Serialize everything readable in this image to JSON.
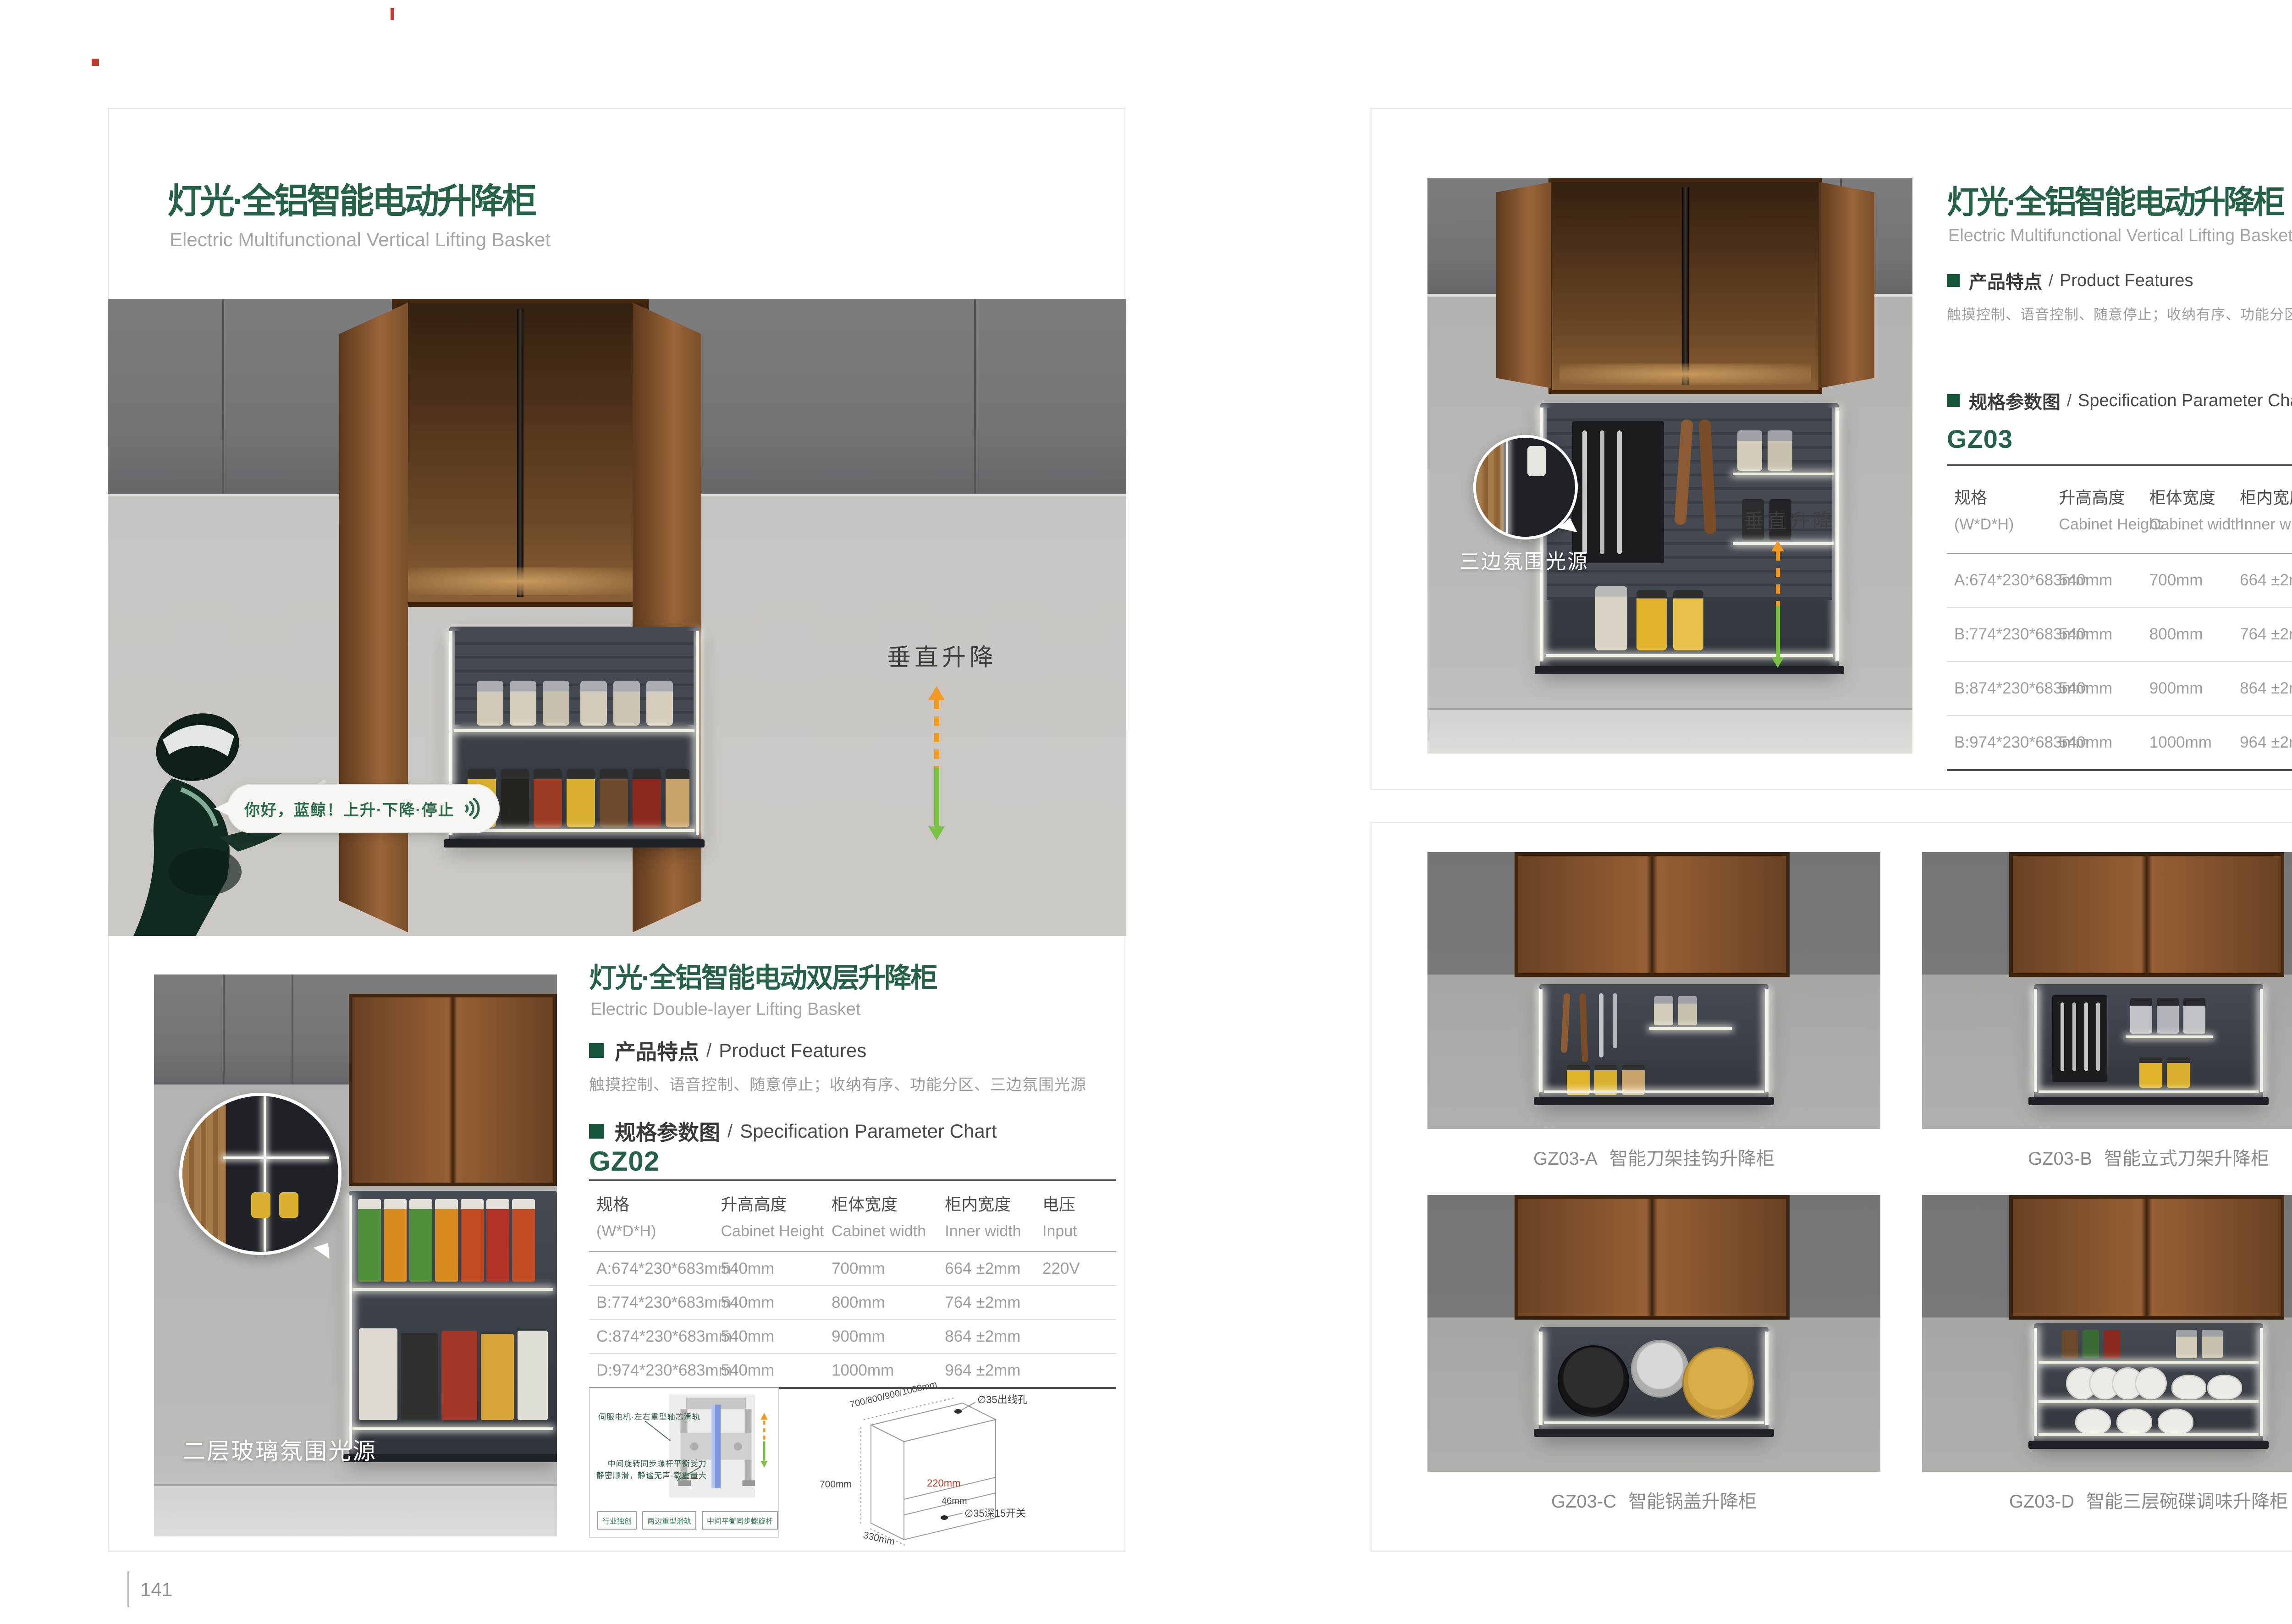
{
  "shared": {
    "sep": "/"
  },
  "colors": {
    "brand_green": "#266247",
    "arrow_orange": "#F29A22",
    "arrow_green": "#7BC143",
    "dim_red": "#C0392B"
  },
  "left_page": {
    "page_number": "141",
    "title": "灯光·全铝智能电动升降柜",
    "subtitle": "Electric Multifunctional Vertical Lifting Basket",
    "hero": {
      "speech_text": "你好，蓝鲸！上升·下降·停止",
      "motion_label": "垂直升降"
    },
    "double_layer": {
      "title": "灯光·全铝智能电动双层升降柜",
      "subtitle": "Electric Double-layer Lifting Basket",
      "features_heading_zh": "产品特点",
      "features_heading_en": "Product Features",
      "features_text": "触摸控制、语音控制、随意停止；收纳有序、功能分区、三边氛围光源",
      "spec_heading_zh": "规格参数图",
      "spec_heading_en": "Specification Parameter Chart",
      "model": "GZ02",
      "photo_label": "二层玻璃氛围光源"
    },
    "mechanism": {
      "callout_top": "伺服电机·左右重型轴芯滑轨",
      "callout_bottom_line1": "中间旋转同步螺杆平衡受力",
      "callout_bottom_line2": "静密顺滑，静谧无声·载重量大",
      "tags": [
        "行业独创",
        "两边重型滑轨",
        "中间平衡同步螺旋杆"
      ]
    },
    "dim_diagram": {
      "width_options": "700/800/900/1000mm",
      "cabinet_height": "700mm",
      "cabinet_depth": "330mm",
      "lift_clearance": "220mm",
      "switch_offset": "46mm",
      "wire_hole": "∅35出线孔",
      "switch_hole": "∅35深15开关"
    }
  },
  "right_page": {
    "page_number": "142",
    "title": "灯光·全铝智能电动升降柜",
    "subtitle": "Electric Multifunctional Vertical Lifting Basket",
    "features_heading_zh": "产品特点",
    "features_heading_en": "Product Features",
    "features_text": "触摸控制、语音控制、随意停止；收纳有序、功能分区、三边氛围光源",
    "spec_heading_zh": "规格参数图",
    "spec_heading_en": "Specification Parameter Chart",
    "model": "GZ03",
    "photo_label": "三边氛围光源",
    "motion_label": "垂直升降",
    "products": [
      {
        "code": "GZ03-A",
        "name": "智能刀架挂钩升降柜"
      },
      {
        "code": "GZ03-B",
        "name": "智能立式刀架升降柜"
      },
      {
        "code": "GZ03-C",
        "name": "智能锅盖升降柜"
      },
      {
        "code": "GZ03-D",
        "name": "智能三层碗碟调味升降柜"
      }
    ]
  },
  "spec_table": {
    "headers": [
      {
        "zh": "规格",
        "en": "(W*D*H)"
      },
      {
        "zh": "升高高度",
        "en": "Cabinet Height"
      },
      {
        "zh": "柜体宽度",
        "en": "Cabinet width"
      },
      {
        "zh": "柜内宽度",
        "en": "Inner width"
      },
      {
        "zh": "电压",
        "en": "Input"
      }
    ],
    "gz02_rows": [
      [
        "A:674*230*683mm",
        "540mm",
        "700mm",
        "664 ±2mm",
        "220V"
      ],
      [
        "B:774*230*683mm",
        "540mm",
        "800mm",
        "764 ±2mm",
        ""
      ],
      [
        "C:874*230*683mm",
        "540mm",
        "900mm",
        "864 ±2mm",
        ""
      ],
      [
        "D:974*230*683mm",
        "540mm",
        "1000mm",
        "964 ±2mm",
        ""
      ]
    ],
    "gz03_rows": [
      [
        "A:674*230*683mm",
        "540mm",
        "700mm",
        "664 ±2mm",
        "220V"
      ],
      [
        "B:774*230*683mm",
        "540mm",
        "800mm",
        "764 ±2mm",
        ""
      ],
      [
        "B:874*230*683mm",
        "540mm",
        "900mm",
        "864 ±2mm",
        ""
      ],
      [
        "B:974*230*683mm",
        "540mm",
        "1000mm",
        "964 ±2mm",
        ""
      ]
    ]
  }
}
